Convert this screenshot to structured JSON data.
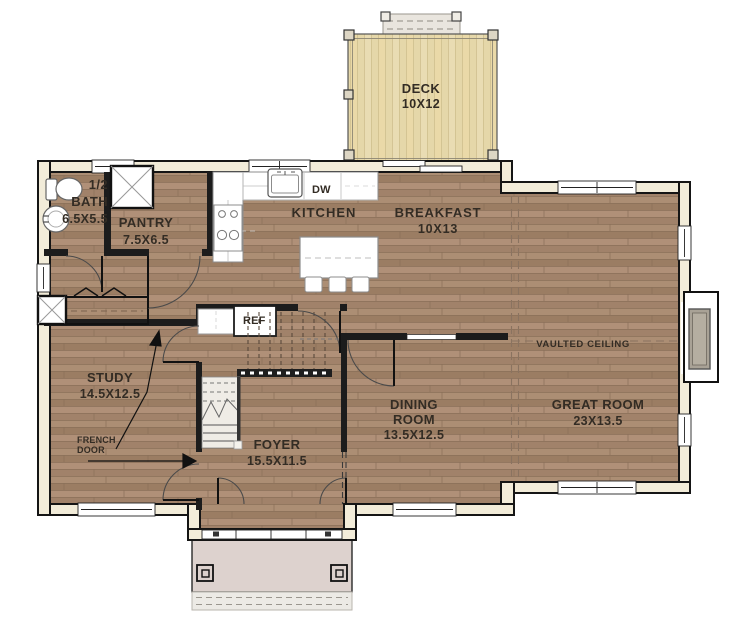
{
  "rooms": {
    "deck": {
      "name": "DECK",
      "dims": "10X12"
    },
    "half_bath": {
      "prefix": "1/2",
      "name": "BATH",
      "dims": "6.5X5.5"
    },
    "pantry": {
      "name": "PANTRY",
      "dims": "7.5X6.5"
    },
    "kitchen": {
      "name": "KITCHEN"
    },
    "breakfast": {
      "name": "BREAKFAST",
      "dims": "10X13"
    },
    "great_room": {
      "name": "GREAT ROOM",
      "dims": "23X13.5",
      "ceiling_note": "VAULTED CEILING"
    },
    "dining_room": {
      "name_line1": "DINING",
      "name_line2": "ROOM",
      "dims": "13.5X12.5"
    },
    "study": {
      "name": "STUDY",
      "dims": "14.5X12.5"
    },
    "foyer": {
      "name": "FOYER",
      "dims": "15.5X11.5"
    }
  },
  "fixtures": {
    "refrigerator": "REF",
    "dishwasher": "DW"
  },
  "annotations": {
    "french_door_line1": "FRENCH",
    "french_door_line2": "DOOR"
  },
  "colors": {
    "floor_wood": "#a5866c",
    "deck_wood": "#e5d7a9",
    "porch": "#ddd2ce",
    "wall_fill": "#f2ecd9",
    "wall_line": "#151515",
    "label_text": "#332c24"
  }
}
